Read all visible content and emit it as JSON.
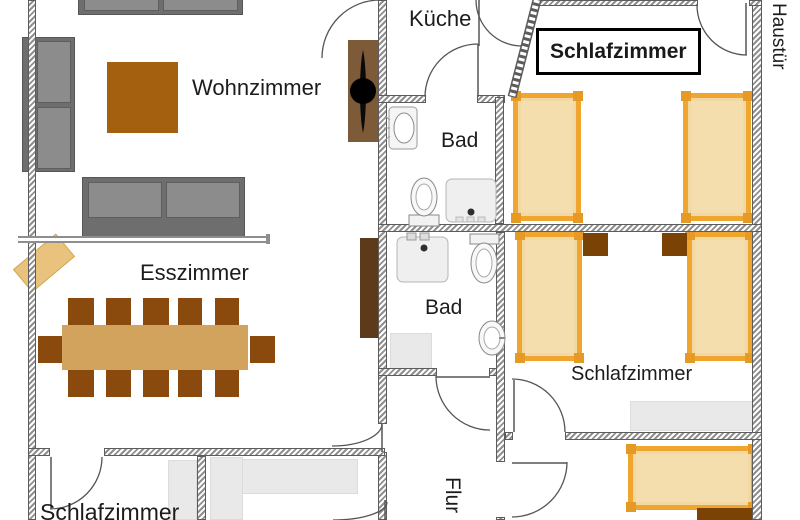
{
  "rooms": {
    "wohnzimmer": {
      "label": "Wohnzimmer"
    },
    "kueche": {
      "label": "Küche"
    },
    "schlafzimmer_top": {
      "label": "Schlafzimmer"
    },
    "schlafzimmer_mid": {
      "label": "Schlafzimmer"
    },
    "schlafzimmer_bottom_left": {
      "label": "Schlafzimmer"
    },
    "bad_upper": {
      "label": "Bad"
    },
    "bad_lower": {
      "label": "Bad"
    },
    "esszimmer": {
      "label": "Esszimmer"
    },
    "flur": {
      "label": "Flur"
    },
    "haustuer": {
      "label": "Haustür"
    }
  },
  "furniture": {
    "beds": 5,
    "dining_chairs": 12,
    "sofas": 3,
    "nightstands": 3,
    "bathrooms": {
      "sinks": 2,
      "toilets": 2,
      "showers": 2
    }
  },
  "colors": {
    "bed_fill": "#F2D9A3",
    "bed_inner": "#F4DEAE",
    "bed_border": "#F0A62E",
    "bed_corner": "#E69A26",
    "sofa_body": "#6E6E6E",
    "sofa_cushion": "#8C8C8C",
    "coffee_table": "#A4600E",
    "dining_table": "#D2A35C",
    "chair": "#8A4A0E",
    "sideboard": "#E9C27D",
    "nightstand": "#7B4206",
    "wardrobe_dark": "#5D3B1A",
    "stove": "#7D5B39",
    "counter": "#E9E9E9",
    "wall_stripe": "#8F8F8F"
  }
}
